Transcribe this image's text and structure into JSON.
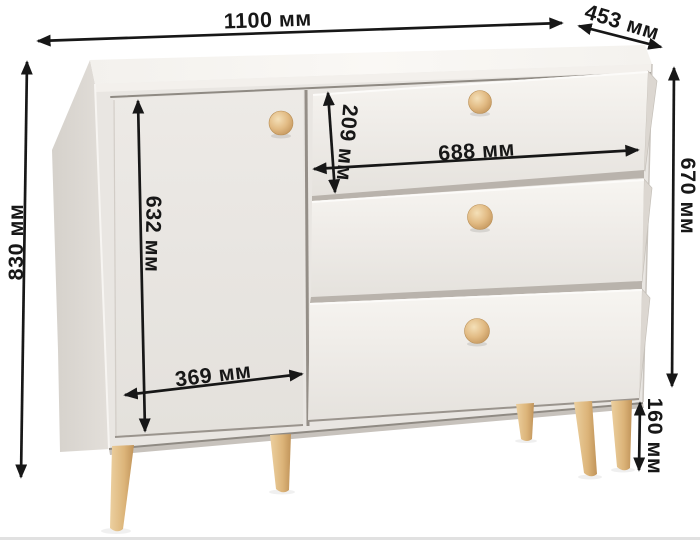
{
  "diagram": {
    "product": "chest-of-drawers-dimension-diagram",
    "unit": "мм",
    "labels": {
      "overall_width": "1100 мм",
      "depth": "453 мм",
      "overall_height": "830 мм",
      "body_height": "670 мм",
      "door_height": "632 мм",
      "door_width": "369 мм",
      "drawer_height": "209 мм",
      "drawer_width": "688 мм",
      "leg_height": "160 мм"
    },
    "colors": {
      "annotation": "#171717",
      "background": "#ffffff",
      "body_top": "#f8f6f3",
      "body_front": "#e9e6e2",
      "body_side": "#d9d5d0",
      "gap_line": "#8f8a83",
      "wood_knob": "#e2bb84",
      "wood_leg": "#d9b278"
    }
  }
}
